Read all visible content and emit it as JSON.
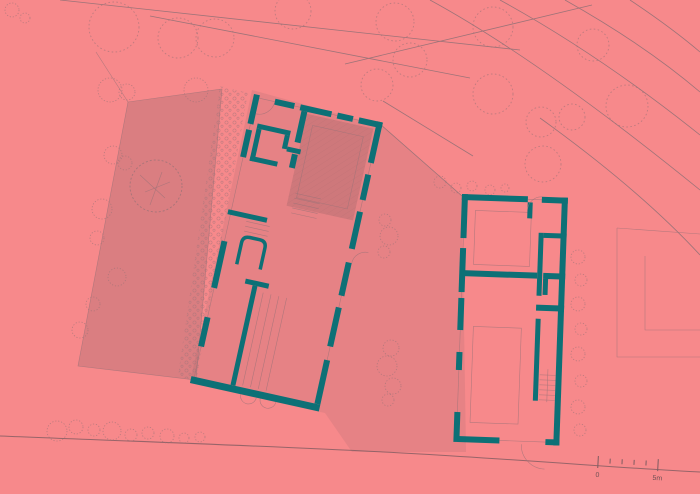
{
  "colors": {
    "background": "#f7898b",
    "wall": "#0d7076",
    "line": "#9d7378",
    "line_strong": "#7e5b60",
    "text": "#6f5054",
    "shade_garden": "rgba(130,95,100,0.25)",
    "shade_central": "rgba(130,95,100,0.14)",
    "shade_room": "rgba(110,80,85,0.20)"
  },
  "scale_bar": {
    "start_label": "0",
    "end_label": "5m"
  }
}
